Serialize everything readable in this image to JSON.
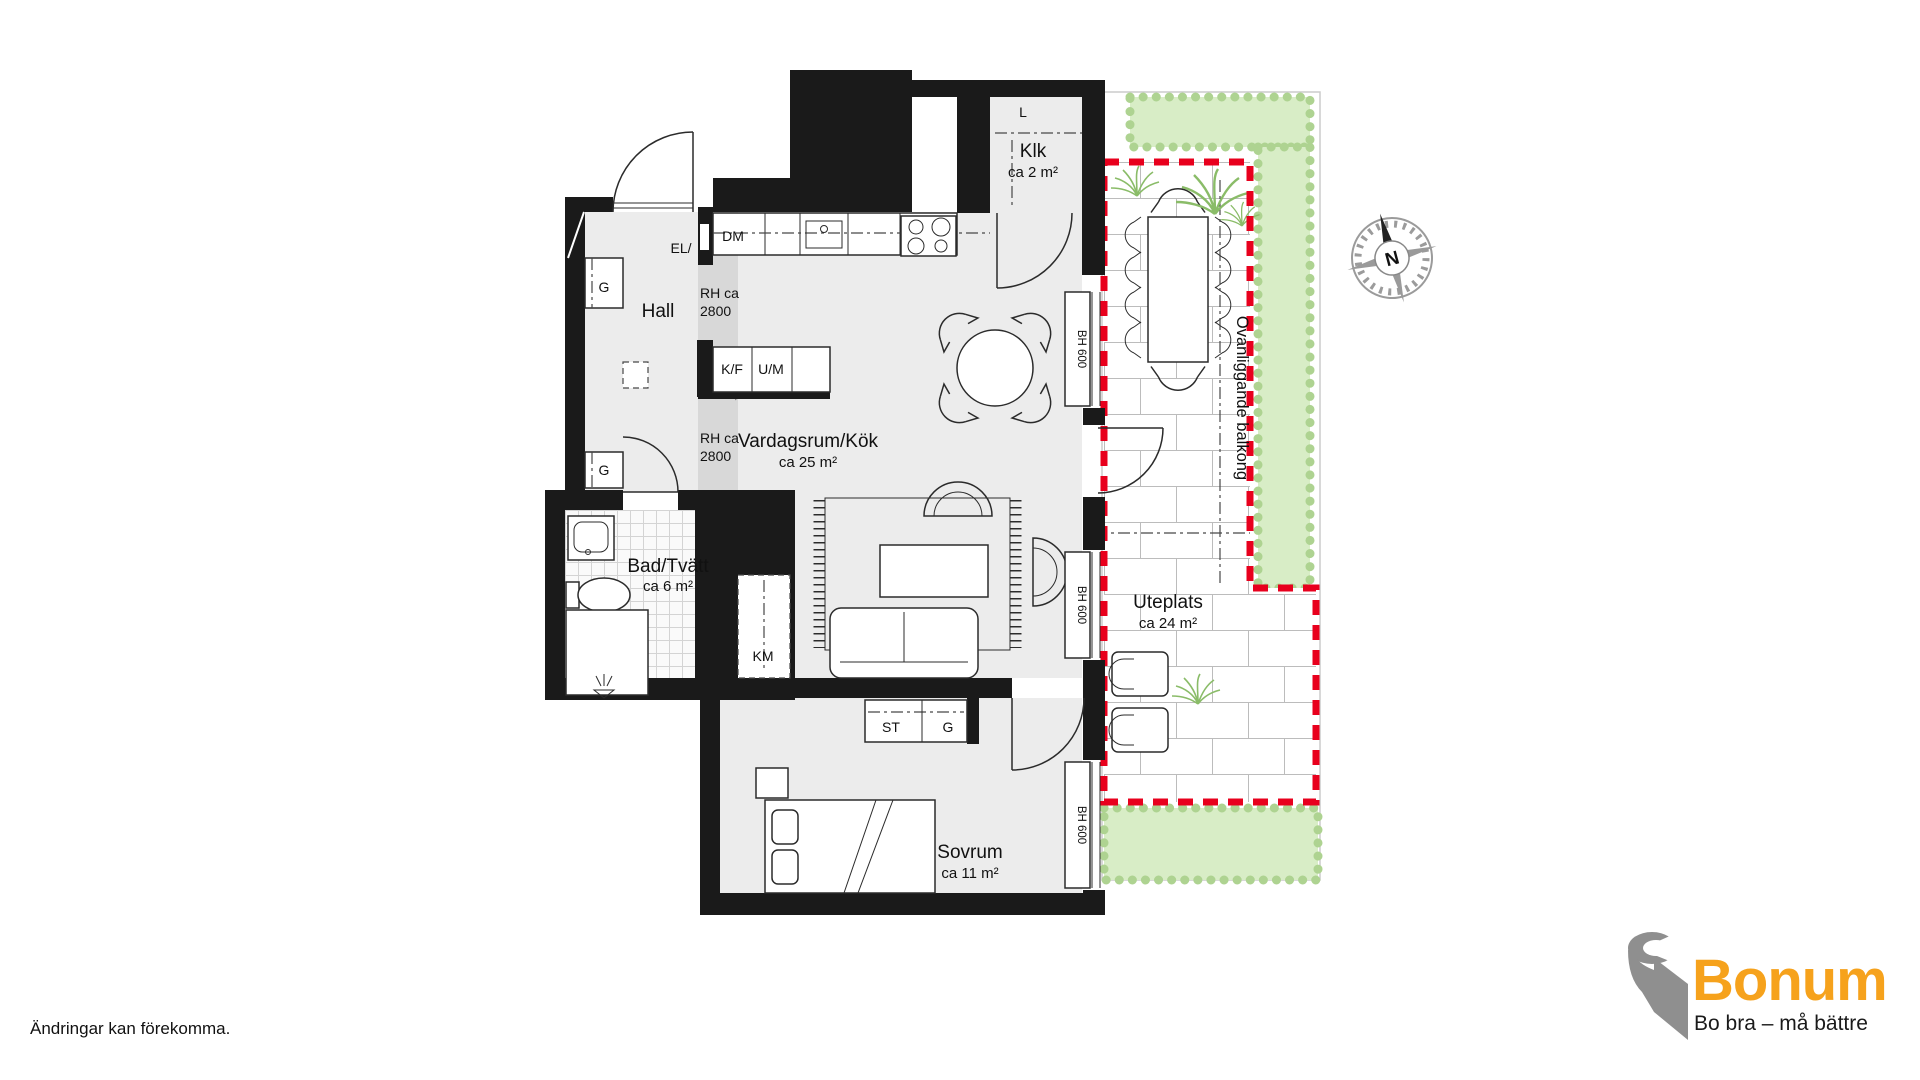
{
  "page": {
    "footer_note": "Ändringar kan förekomma."
  },
  "logo": {
    "brand": "Bonum",
    "tagline": "Bo bra – må bättre"
  },
  "compass_n": "N",
  "rooms": [
    {
      "name": "Klk",
      "area": "ca 2 m²"
    },
    {
      "name": "Hall",
      "area": ""
    },
    {
      "name": "Vardagsrum/Kök",
      "area": "ca 25 m²"
    },
    {
      "name": "Bad/Tvätt",
      "area": "ca 6 m²"
    },
    {
      "name": "Sovrum",
      "area": "ca 11 m²"
    },
    {
      "name": "Uteplats",
      "area": "ca 24 m²"
    }
  ],
  "labels": {
    "closet_rod": "L",
    "electrical": "EL/",
    "dishwasher": "DM",
    "wardrobe_hall_upper": "G",
    "wardrobe_hall_lower": "G",
    "fridge_freezer": "K/F",
    "oven_micro": "U/M",
    "ceiling_height_line1": "RH ca",
    "ceiling_height_line2": "2800",
    "washing_machine": "KM",
    "cleaning_cabinet": "ST",
    "wardrobe_bedroom": "G"
  },
  "windows": [
    "BH 600",
    "BH 600",
    "BH 600"
  ],
  "balcony_note": "Ovanliggande balkong",
  "colors": {
    "wall": "#1a1a1a",
    "floor": "#ececec",
    "lowered_ceiling": "#d8d8d8",
    "patio_line": "#e8001d",
    "hedge_fill": "#d8edc6",
    "hedge_edge": "#aed391",
    "plant_green": "#8abc68",
    "brand_orange": "#f6a21c",
    "logo_gray": "#8f8f8f"
  }
}
